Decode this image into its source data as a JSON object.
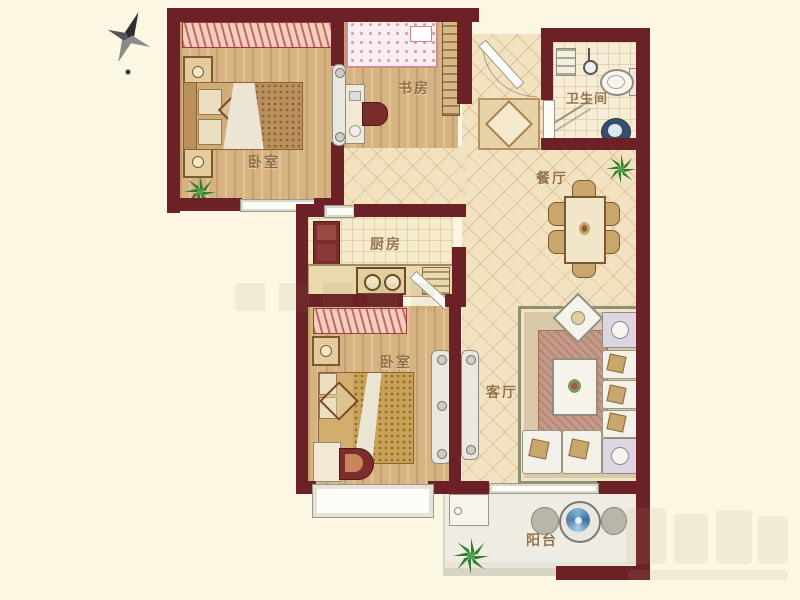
{
  "rooms": {
    "bedroom1": {
      "label": "卧室"
    },
    "study": {
      "label": "书房"
    },
    "bathroom": {
      "label": "卫生间"
    },
    "dining": {
      "label": "餐厅"
    },
    "kitchen": {
      "label": "厨房"
    },
    "bedroom2": {
      "label": "卧室"
    },
    "living": {
      "label": "客厅"
    },
    "balcony": {
      "label": "阳台"
    }
  },
  "icons": {
    "compass": "compass-north-pointer",
    "plants": "potted-plant",
    "washer": "washing-machine",
    "toilet": "toilet",
    "sink": "wash-basin",
    "shower": "shower-head",
    "fridge": "refrigerator",
    "stove": "two-burner-stove"
  },
  "colors": {
    "background": "#fcf7e3",
    "wall": "#6b2126",
    "wood_floor": "#d7b382",
    "tile_floor": "#f3e2c0",
    "grid_floor": "#f6eccd",
    "balcony_floor": "#efede3",
    "curtain_pink": "#f3cdbf",
    "accent_dark_red": "#7a2d2a",
    "washer_blue": "#5e8fc0",
    "plant_green": "#2f7d2f",
    "label_text": "#8a6840"
  }
}
